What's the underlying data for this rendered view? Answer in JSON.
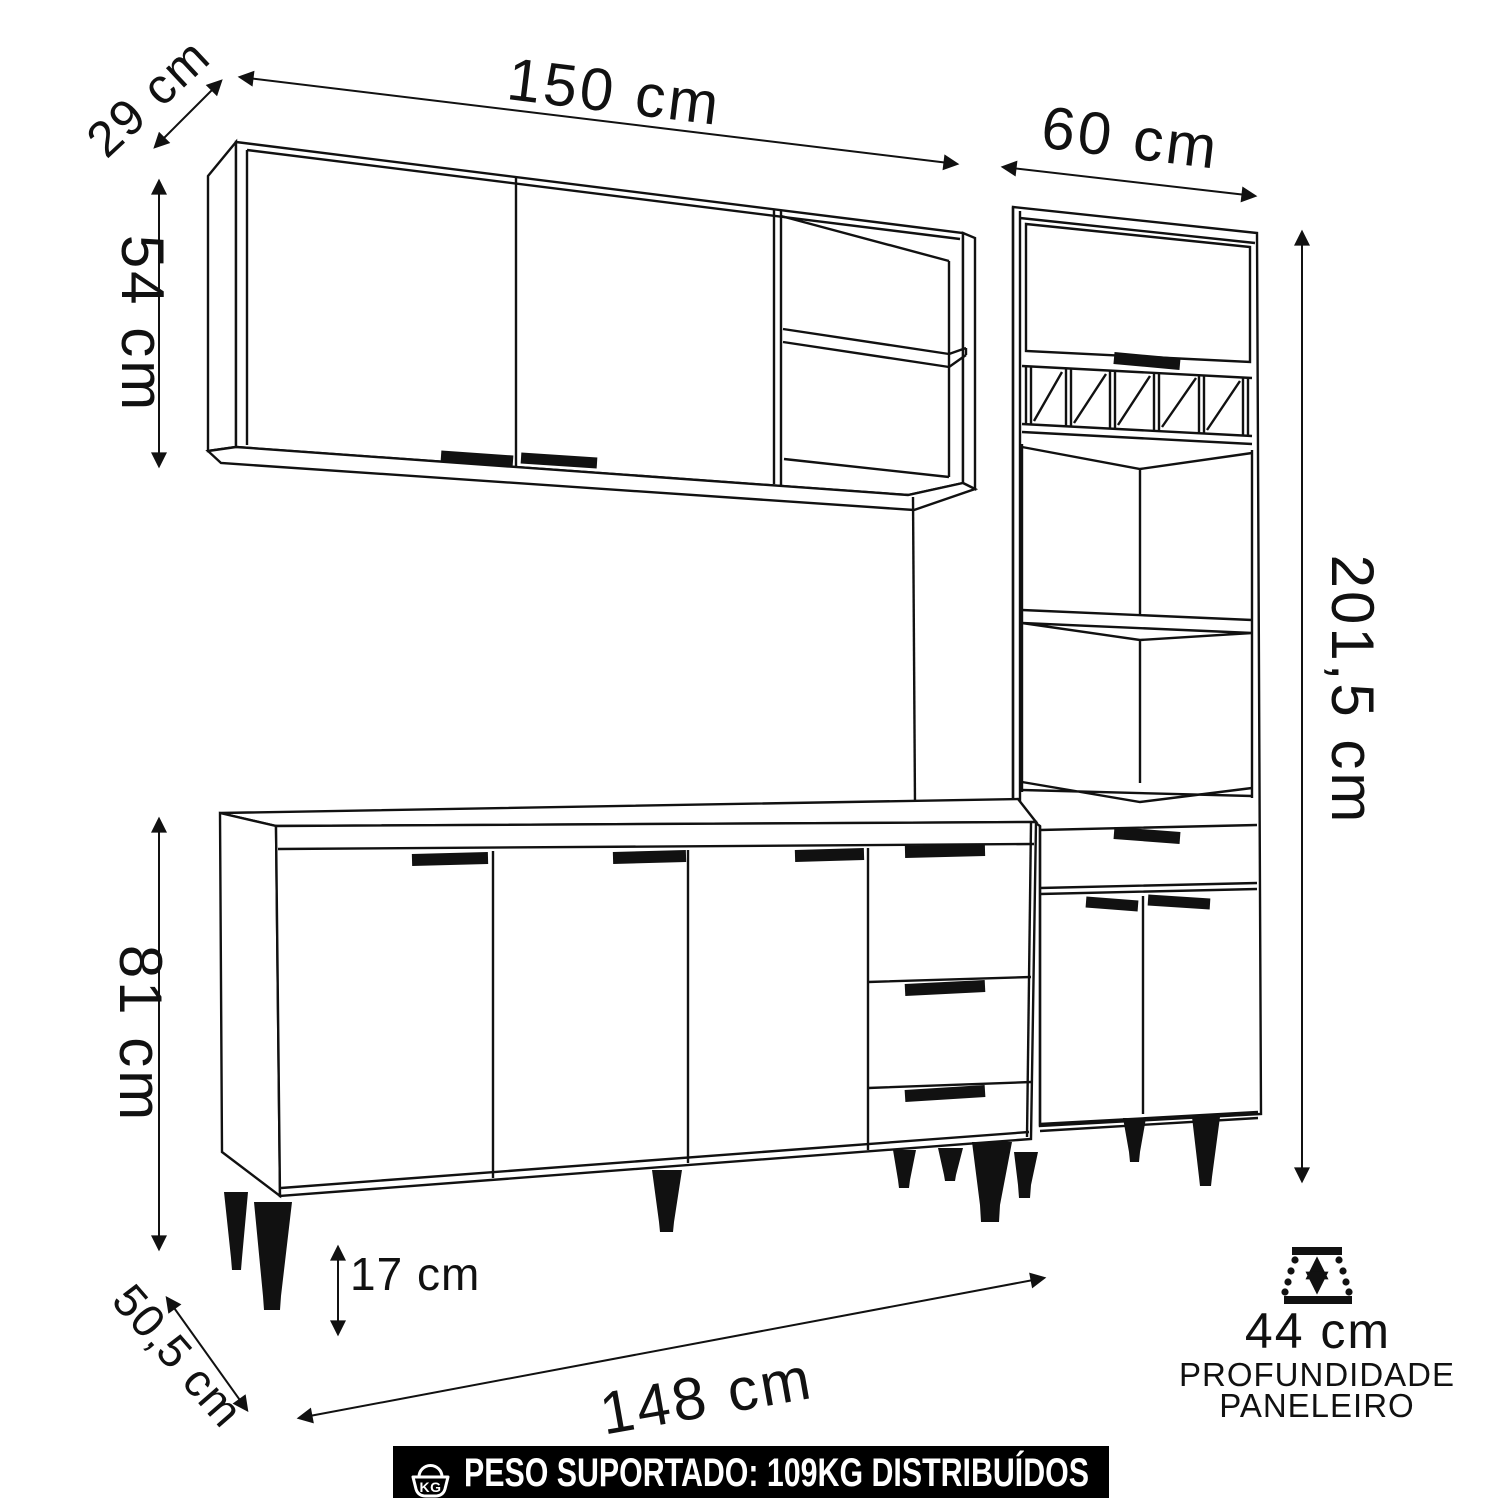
{
  "dimensions": {
    "upper_cabinet_width": "150 cm",
    "upper_cabinet_depth": "29 cm",
    "upper_cabinet_height": "54 cm",
    "paneleiro_width": "60 cm",
    "total_height": "201,5 cm",
    "base_cabinet_height": "81 cm",
    "base_cabinet_depth": "50,5 cm",
    "feet_height": "17 cm",
    "base_cabinet_width": "148 cm",
    "paneleiro_depth_value": "44 cm",
    "paneleiro_depth_caption_line1": "PROFUNDIDADE",
    "paneleiro_depth_caption_line2": "PANELEIRO"
  },
  "banner": {
    "icon_label": "KG",
    "text": "PESO SUPORTADO: 109KG DISTRIBUÍDOS"
  },
  "colors": {
    "line": "#111111",
    "background": "#ffffff",
    "banner_background": "#000000",
    "banner_text": "#ffffff"
  }
}
